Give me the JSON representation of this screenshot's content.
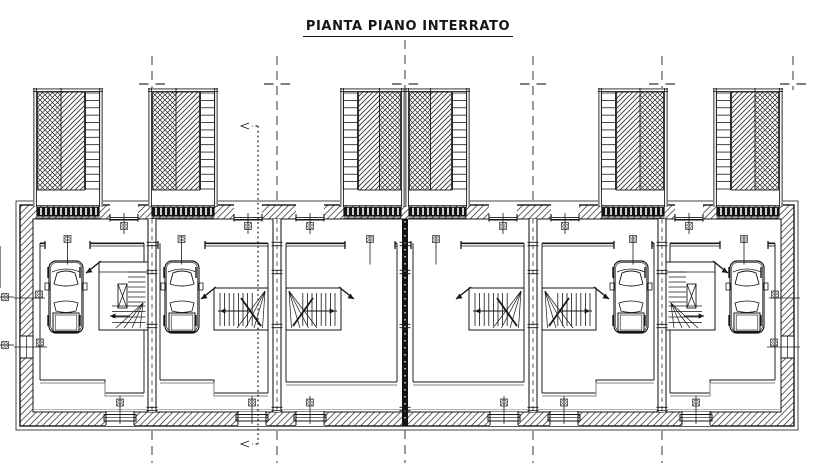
{
  "title": {
    "text": "PIANTA PIANO INTERRATO"
  },
  "palette": {
    "line": "#161616",
    "grey": "#9c9c9c",
    "hatch": "#2d2d2d",
    "wall_hatch": "#4a4a4a",
    "symbol": "#6a6a6a",
    "grate": "#141414",
    "white": "#ffffff"
  },
  "plan": {
    "canvas": {
      "w": 816,
      "h": 476
    },
    "grid": {
      "xs": [
        152,
        277,
        405,
        533,
        662
      ],
      "stub_x": 793,
      "y1": 56,
      "y2": 463,
      "stub_y2": 90,
      "marker_y": 84,
      "center_x": 405,
      "center_top": 40
    },
    "section": {
      "x": 258,
      "y_top": 126,
      "y_bot": 444,
      "arrow_tip_x": 238
    },
    "shell": {
      "x1": 20,
      "y1": 205,
      "x2": 794,
      "y2": 426,
      "ix1": 33,
      "iy1": 219,
      "ix2": 781,
      "iy2": 412,
      "offset": 4
    },
    "center_wall": {
      "x": 405,
      "w": 6,
      "y1": 88,
      "y2": 430
    },
    "party_walls": [
      152,
      277,
      533,
      662
    ],
    "ramps": [
      {
        "x": 33,
        "w": 70,
        "ladder": "right"
      },
      {
        "x": 148,
        "w": 70,
        "ladder": "right"
      },
      {
        "x": 340,
        "w": 65,
        "ladder": "left"
      },
      {
        "x": 405,
        "w": 65,
        "ladder": "right"
      },
      {
        "x": 598,
        "w": 70,
        "ladder": "left"
      },
      {
        "x": 713,
        "w": 70,
        "ladder": "left"
      }
    ],
    "ramp_y": {
      "top": 88,
      "hatch_top": 92,
      "hatch_bot": 190,
      "grate_top": 206,
      "grate_h": 10
    },
    "units": [
      {
        "room": [
          40,
          144
        ],
        "door": [
          45,
          90
        ],
        "car": 66,
        "stair": {
          "type": "U",
          "x": [
            99,
            148
          ],
          "winder": "right"
        },
        "bottom": [
          [
            40,
            380
          ],
          [
            105,
            380
          ],
          [
            105,
            393
          ],
          [
            144,
            393
          ]
        ]
      },
      {
        "room": [
          160,
          268
        ],
        "door": [
          158,
          205
        ],
        "car": 182,
        "stair": {
          "type": "L",
          "x": [
            214,
            268
          ],
          "winder": "right"
        },
        "bottom": [
          [
            160,
            380
          ],
          [
            214,
            380
          ],
          [
            214,
            393
          ],
          [
            268,
            393
          ]
        ]
      },
      {
        "room": [
          286,
          397
        ],
        "door": [
          345,
          395
        ],
        "car": null,
        "stair": {
          "type": "L",
          "x": [
            286,
            341
          ],
          "winder": "left"
        },
        "bottom": [
          [
            286,
            382
          ],
          [
            397,
            382
          ]
        ]
      },
      {
        "room": [
          413,
          524
        ],
        "door": [
          411,
          461
        ],
        "car": null,
        "stair": {
          "type": "L",
          "x": [
            469,
            524
          ],
          "winder": "right"
        },
        "bottom": [
          [
            413,
            382
          ],
          [
            524,
            382
          ]
        ]
      },
      {
        "room": [
          542,
          654
        ],
        "door": [
          614,
          652
        ],
        "car": 631,
        "stair": {
          "type": "L",
          "x": [
            542,
            596
          ],
          "winder": "left"
        },
        "bottom": [
          [
            542,
            393
          ],
          [
            596,
            393
          ],
          [
            596,
            380
          ],
          [
            654,
            380
          ]
        ]
      },
      {
        "room": [
          670,
          775
        ],
        "door": [
          720,
          768
        ],
        "car": 747,
        "stair": {
          "type": "U",
          "x": [
            666,
            715
          ],
          "winder": "left"
        },
        "bottom": [
          [
            670,
            393
          ],
          [
            710,
            393
          ],
          [
            710,
            380
          ],
          [
            775,
            380
          ]
        ]
      }
    ],
    "stair_y": {
      "U": [
        262,
        330
      ],
      "L": [
        288,
        330
      ]
    },
    "door_y": 244.5,
    "car_y": 297,
    "ped_doors": [
      124,
      248,
      310,
      503,
      565,
      689
    ],
    "bottom_windows": [
      120,
      252,
      310,
      504,
      564,
      696
    ],
    "side_openings": {
      "vent_y": 298,
      "window_y1": 336,
      "window_y2": 358,
      "outside_square_ys": [
        297,
        345
      ]
    },
    "ticks": {
      "xs": [
        152,
        277,
        405,
        533,
        662
      ],
      "ys": [
        244,
        272,
        326,
        409
      ]
    }
  }
}
